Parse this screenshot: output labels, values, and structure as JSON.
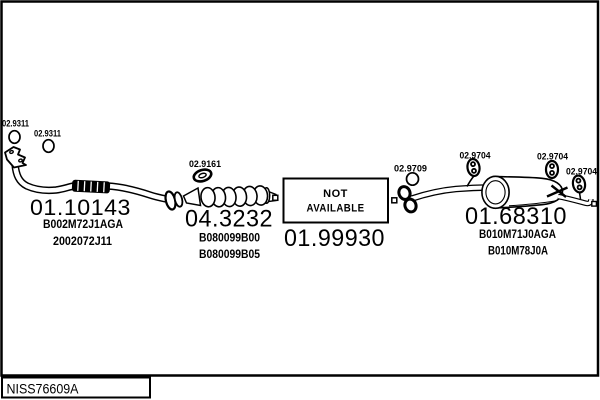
{
  "diagram_ref": "NISS76609A",
  "colors": {
    "line": "#000000",
    "background": "#ffffff"
  },
  "parts": {
    "gasket_ring_1": {
      "code": "02.9311"
    },
    "gasket_ring_2": {
      "code": "02.9311"
    },
    "front_pipe": {
      "code": "01.10143",
      "numbers": [
        "B002M72J1AGA",
        "2002072J11"
      ]
    },
    "cat_gasket": {
      "code": "02.9161"
    },
    "catalyst": {
      "code": "04.3232",
      "numbers": [
        "B080099B00",
        "B080099B05"
      ]
    },
    "mid_pipe": {
      "code": "01.99930",
      "status_words": [
        "NOT",
        "AVAILABLE"
      ]
    },
    "rear_gasket": {
      "code": "02.9709"
    },
    "hanger_1": {
      "code": "02.9704"
    },
    "hanger_2": {
      "code": "02.9704"
    },
    "hanger_3": {
      "code": "02.9704"
    },
    "rear_silencer": {
      "code": "01.68310",
      "numbers": [
        "B010M71J0AGA",
        "B010M78J0A"
      ]
    }
  }
}
